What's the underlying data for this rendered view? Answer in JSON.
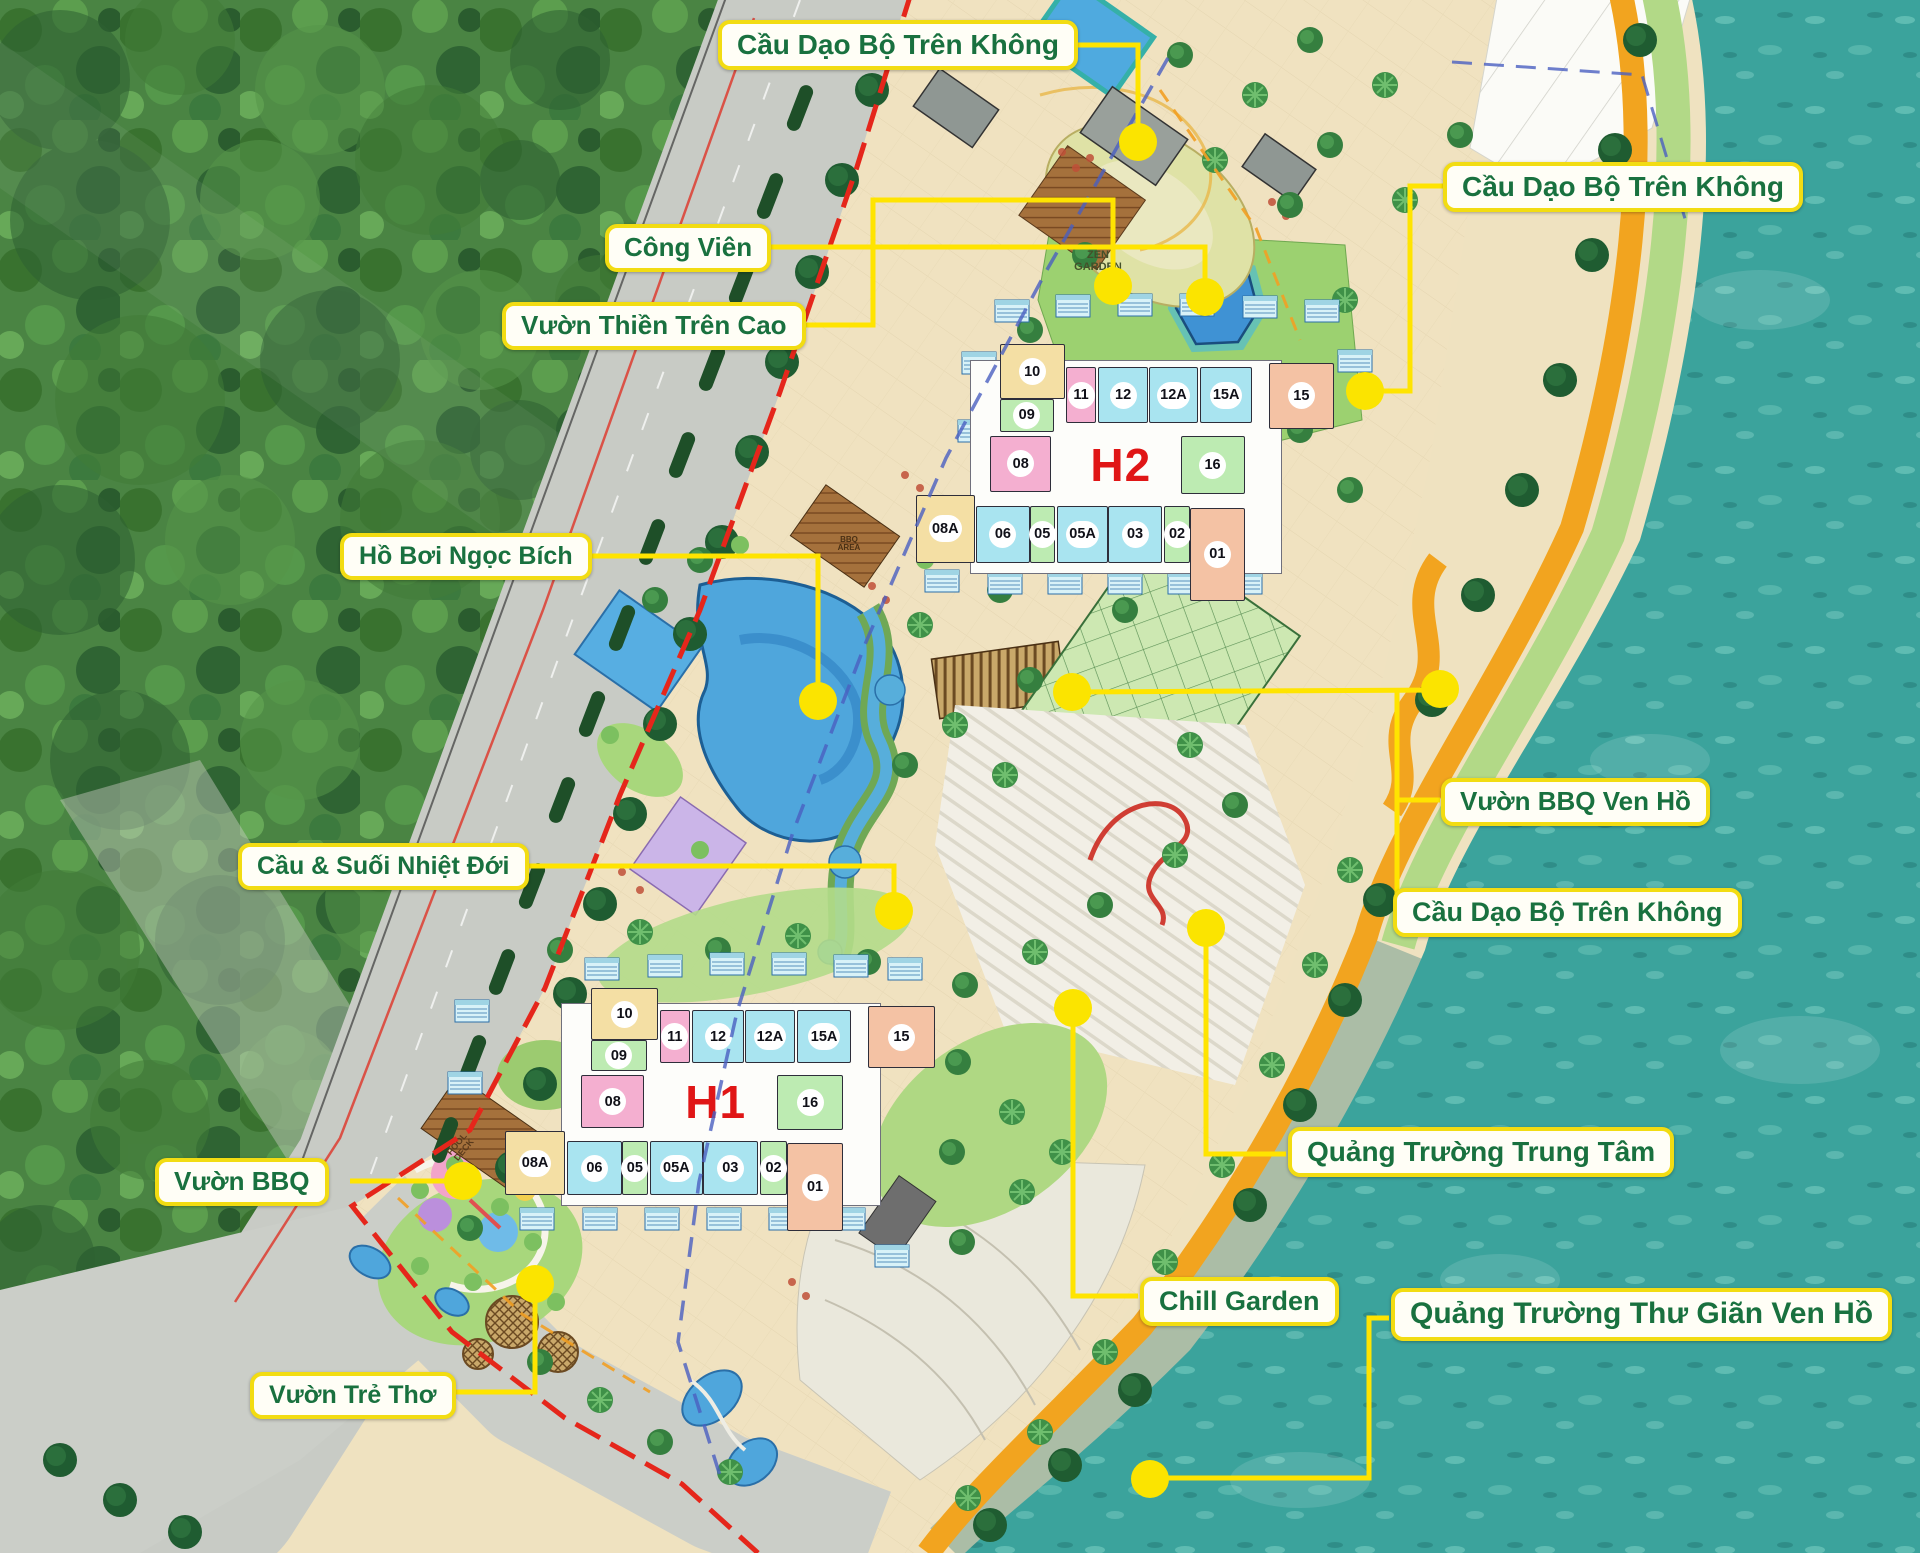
{
  "labels": {
    "sky_bridge_top": "Cầu Dạo Bộ Trên Không",
    "park": "Công Viên",
    "elevated_zen_garden": "Vườn Thiền Trên Cao",
    "jade_pool": "Hồ Bơi Ngọc Bích",
    "tropical_bridge_stream": "Cầu & Suối Nhiệt Đới",
    "bbq_garden": "Vườn BBQ",
    "children_garden": "Vườn Trẻ Thơ",
    "sky_bridge_right": "Cầu Dạo Bộ Trên Không",
    "lakeside_bbq_garden": "Vườn BBQ Ven Hồ",
    "sky_bridge_mid": "Cầu Dạo Bộ Trên Không",
    "central_square": "Quảng Trường Trung Tâm",
    "chill_garden": "Chill Garden",
    "lakeside_relaxation_square": "Quảng Trường Thư Giãn Ven Hồ"
  },
  "buildings": {
    "h1": {
      "name": "H1",
      "units": [
        "10",
        "09",
        "08",
        "11",
        "12",
        "12A",
        "15A",
        "15",
        "16",
        "08A",
        "06",
        "05",
        "05A",
        "03",
        "02",
        "01"
      ]
    },
    "h2": {
      "name": "H2",
      "units": [
        "10",
        "09",
        "08",
        "11",
        "12",
        "12A",
        "15A",
        "15",
        "16",
        "08A",
        "06",
        "05",
        "05A",
        "03",
        "02",
        "01"
      ]
    }
  },
  "map_texts": {
    "zen_garden": "ZEN GARDEN",
    "bbq_area": "BBQ AREA",
    "pool_deck": "POOL DECK"
  },
  "colors": {
    "label_border": "#F2DC12",
    "label_text": "#19713F",
    "connector": "#FFE400",
    "building_name": "#E01616",
    "unit_tan": "#F4DFA4",
    "unit_pink": "#F4AFD0",
    "unit_cyan": "#A9E4F0",
    "unit_green": "#BDEBB2",
    "unit_salmon": "#F4C2A4",
    "water": "#3BA39C",
    "promenade": "#F2A41F",
    "boundary_red": "#E5261B",
    "boundary_blue": "#4A5FC0",
    "road": "#C8CBC5",
    "forest": "#4A8443",
    "paving": "#F0E2C0"
  }
}
